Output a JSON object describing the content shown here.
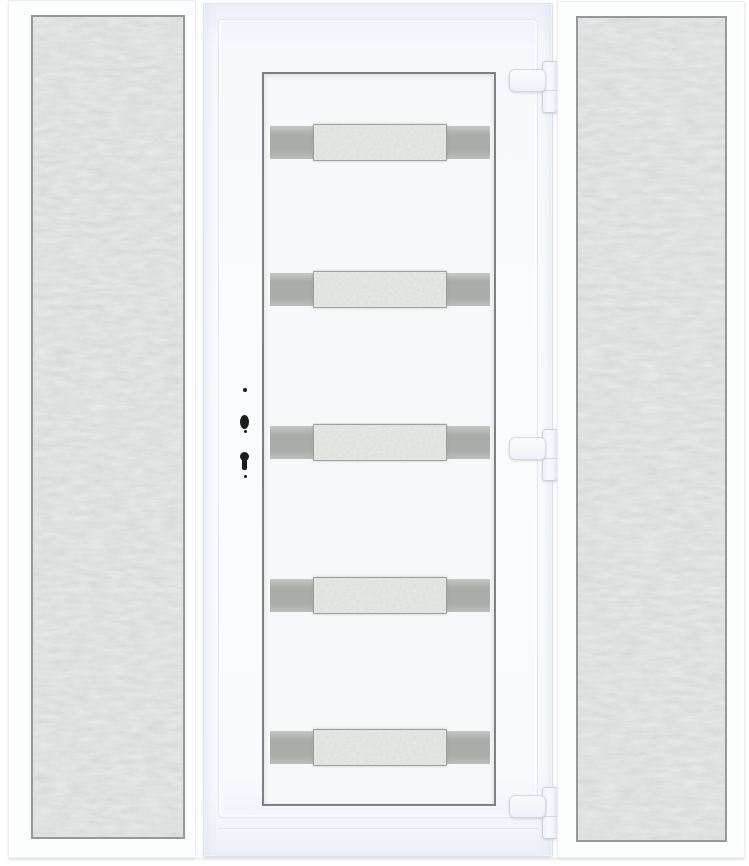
{
  "meta": {
    "title": "White uPVC entry door with two sidelights",
    "description": "Product photo: white PVC front door with five horizontal frosted glass strips with grey end caps, flanked by two full-height textured-glass sidelight panels; three hinges on the right edge and lock cylinder bores on the left stile.",
    "aria": {
      "scene": "White PVC entry door with two frosted sidelight panels",
      "left_sidelight": "Left sidelight panel with textured privacy glass",
      "right_sidelight": "Right sidelight panel with textured privacy glass",
      "door_unit": "White door leaf in frame with five horizontal glazed strips",
      "door_glass": "Central glazing panel with five frosted strips",
      "hinge_top": "Top hinge",
      "hinge_middle": "Middle hinge",
      "hinge_bottom": "Bottom hinge",
      "lock_area": "Lock cylinder and keyhole bores"
    }
  },
  "door": {
    "glass_strip_count": 5,
    "strip_parts": [
      "grey-cap-left",
      "frosted-center",
      "grey-cap-right"
    ],
    "hinges": [
      "top",
      "middle",
      "bottom"
    ],
    "lock_hardware": [
      "screw-bore",
      "cylinder-bore",
      "screw-bore",
      "keyhole-bore",
      "screw-bore"
    ]
  },
  "colors": {
    "background": "#ffffff",
    "frame_white": "#fcfdfd",
    "door_frame_tint": "#eef1f8",
    "glass_border_grey": "#96999b",
    "sidelight_glass_grey": "#dfe1e0",
    "strip_cap_grey": "#a9ada9",
    "strip_glass_grey": "#e6e8e6",
    "hinge_white": "#f5f7fa",
    "hardware_black": "#1b1b1d"
  }
}
